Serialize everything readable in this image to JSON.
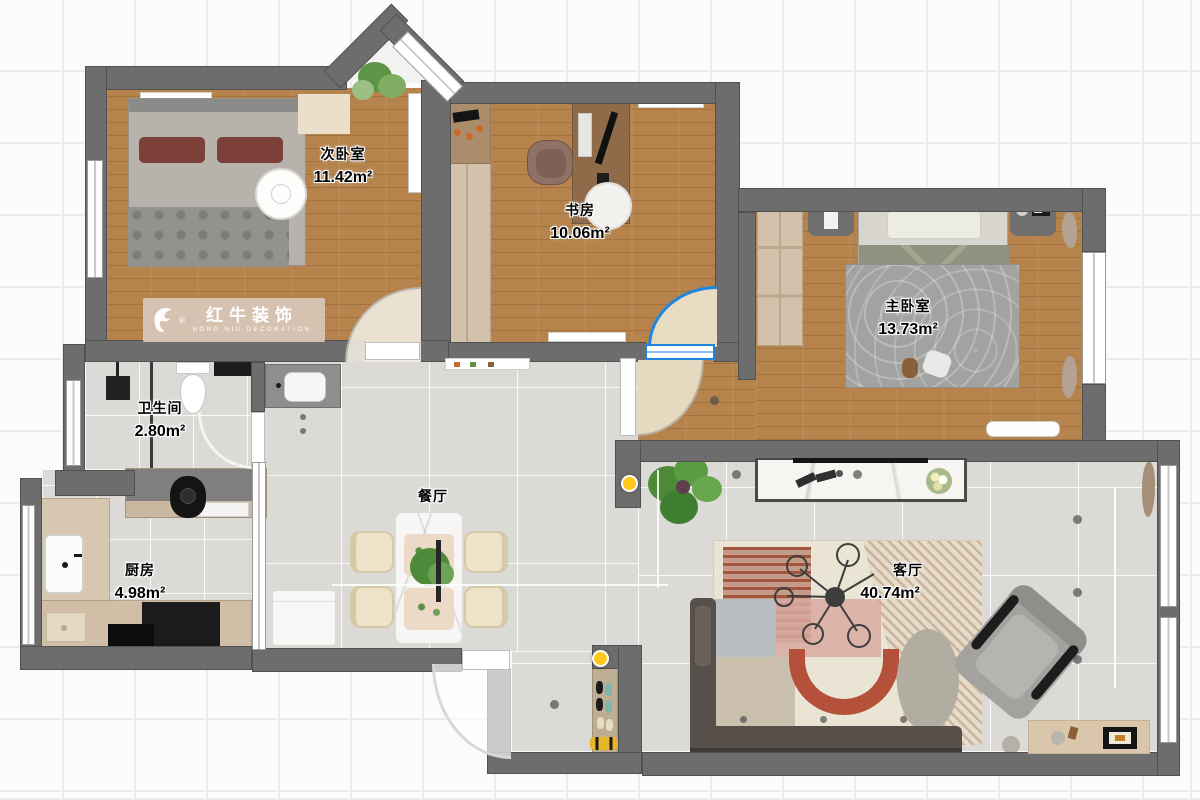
{
  "watermark": {
    "brand_cn": "红牛装饰",
    "brand_en": "HONG NIU DECORATION",
    "registered": "®"
  },
  "rooms": {
    "secondary_bedroom": {
      "name": "次卧室",
      "area": "11.42m²"
    },
    "study": {
      "name": "书房",
      "area": "10.06m²"
    },
    "master_bedroom": {
      "name": "主卧室",
      "area": "13.73m²"
    },
    "bathroom": {
      "name": "卫生间",
      "area": "2.80m²"
    },
    "kitchen": {
      "name": "厨房",
      "area": "4.98m²"
    },
    "dining_room": {
      "name": "餐厅",
      "area": ""
    },
    "living_room": {
      "name": "客厅",
      "area": "40.74m²"
    }
  },
  "colors": {
    "wall": "#6d6d6d",
    "wood_floor": "#b5834b",
    "tile_floor": "#dbdad6",
    "accent_door_blue": "#1e86e0",
    "light_yellow": "#ffc91c",
    "watermark_band": "#d6c1b2"
  }
}
